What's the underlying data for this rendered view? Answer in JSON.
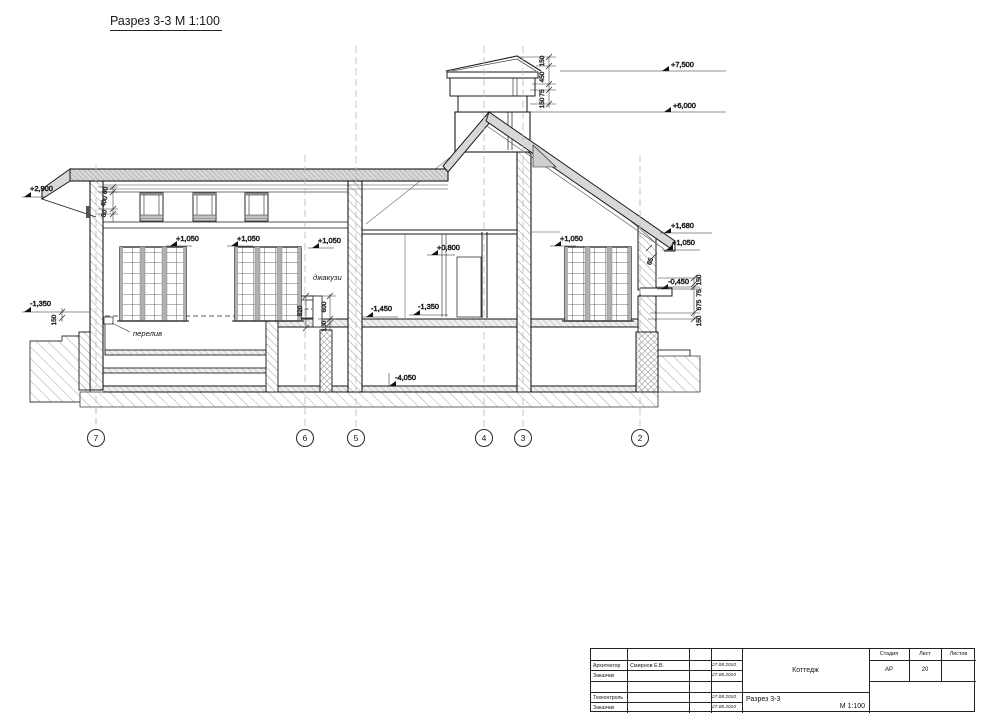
{
  "page": {
    "title": "Разрез 3-3 М 1:100"
  },
  "drawing": {
    "axes": [
      "7",
      "6",
      "5",
      "4",
      "3",
      "2"
    ],
    "elev": {
      "e7500": "+7,500",
      "e6000": "+6,000",
      "e2900": "+2,900",
      "m1350": "-1,350",
      "p1050": "+1,050",
      "p0800": "+0,800",
      "m1450": "-1,450",
      "m4050": "-4,050",
      "p1680": "+1,680",
      "m0450": "-0,450"
    },
    "dims": {
      "chimney": [
        "150",
        "450",
        "75",
        "150"
      ],
      "eave_left": [
        "80",
        "400",
        "80"
      ],
      "eave_right": "65",
      "chain_right": [
        "150",
        "75",
        "675",
        "150"
      ],
      "ground_left": "150",
      "jacuzzi": [
        "820",
        "600",
        "100"
      ]
    },
    "notes": {
      "jacuzzi": "джакузи",
      "overflow": "перелив"
    }
  },
  "titleblock": {
    "roles": {
      "r1": "Архитектор",
      "r2": "Заказчик",
      "r3": "Техконтроль",
      "r4": "Заказчик"
    },
    "architect_name": "Смирнов Е.В.",
    "dates": [
      "27.08.2010",
      "27.08.2010",
      "27.08.2010",
      "27.08.2010"
    ],
    "project": "Коттедж",
    "sheet_title": "Разрез 3-3",
    "scale": "М 1:100",
    "stage_label": "Стадия",
    "sheet_label": "Лист",
    "sheets_label": "Листов",
    "stage": "АР",
    "sheet_no": "20"
  }
}
